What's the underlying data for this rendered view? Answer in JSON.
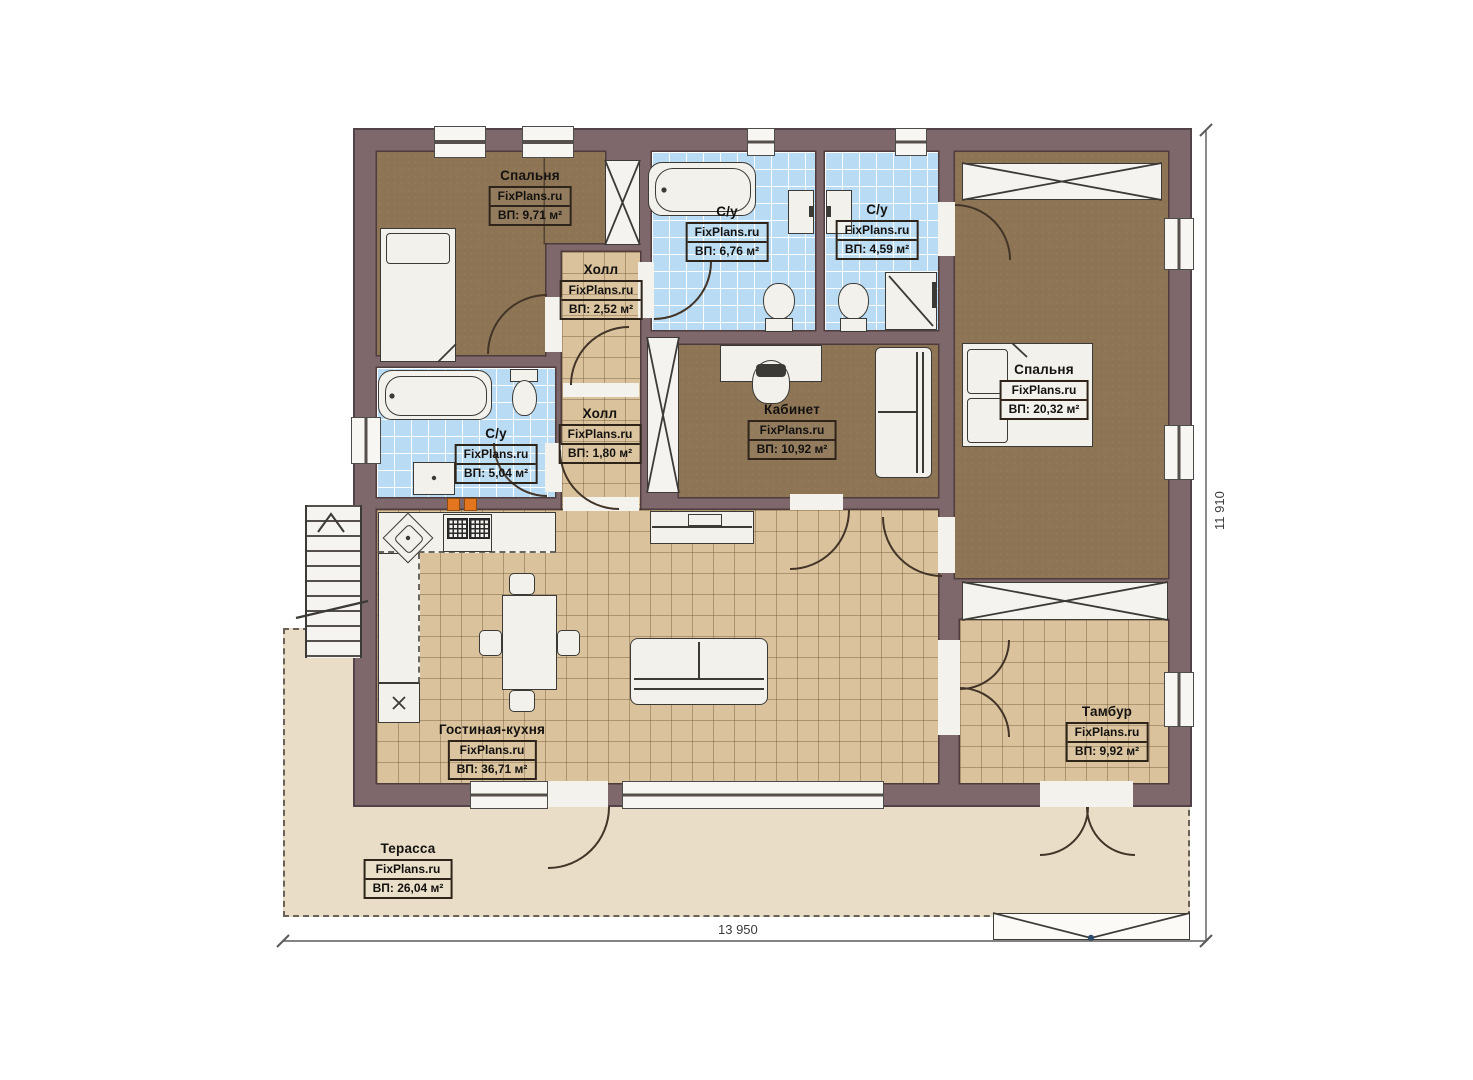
{
  "plan": {
    "brand": "FixPlans.ru",
    "rooms": [
      {
        "id": "bedroom-1",
        "name": "Спальня",
        "area": "ВП: 9,71 м²"
      },
      {
        "id": "hall-1",
        "name": "Холл",
        "area": "ВП: 2,52 м²"
      },
      {
        "id": "bathroom-1",
        "name": "С/у",
        "area": "ВП: 6,76 м²"
      },
      {
        "id": "bathroom-2",
        "name": "С/у",
        "area": "ВП: 4,59 м²"
      },
      {
        "id": "bedroom-2",
        "name": "Спальня",
        "area": "ВП: 20,32 м²"
      },
      {
        "id": "bathroom-3",
        "name": "С/у",
        "area": "ВП: 5,04 м²"
      },
      {
        "id": "hall-2",
        "name": "Холл",
        "area": "ВП: 1,80 м²"
      },
      {
        "id": "office",
        "name": "Кабинет",
        "area": "ВП: 10,92 м²"
      },
      {
        "id": "living-kitchen",
        "name": "Гостиная-кухня",
        "area": "ВП: 36,71 м²"
      },
      {
        "id": "vestibule",
        "name": "Тамбур",
        "area": "ВП: 9,92 м²"
      },
      {
        "id": "terrace",
        "name": "Терасса",
        "area": "ВП: 26,04 м²"
      }
    ],
    "dimensions": {
      "width": "13 950",
      "height": "11 910"
    },
    "colors": {
      "wall": "#7f686c",
      "bedroom_floor": "#8d7454",
      "tile_tan": "#d9c29c",
      "tile_blue": "#b9dbf4",
      "terrace": "#e9ddc7",
      "marker_orange": "#e2751d"
    }
  }
}
